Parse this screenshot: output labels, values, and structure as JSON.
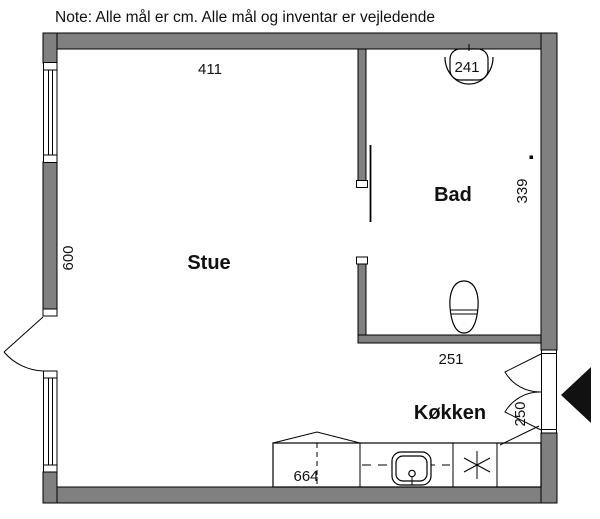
{
  "note": "Note: Alle mål er cm. Alle mål og inventar er vejledende",
  "rooms": {
    "stue": "Stue",
    "bad": "Bad",
    "kokken": "Køkken"
  },
  "dimensions_cm": {
    "stue_top_width": "411",
    "stue_left_height": "600",
    "bad_top_width": "241",
    "bad_right_height": "339",
    "bad_bottom_width": "251",
    "entry_door_width": "250",
    "kitchen_counter": "664"
  },
  "fixtures": {
    "bathroom": [
      "washbasin",
      "toilet"
    ],
    "kitchen": [
      "kitchen-counter",
      "kitchen-sink",
      "cooktop"
    ]
  },
  "doors": [
    "entry-double-door",
    "balcony-door-left",
    "sliding-door-bathroom"
  ],
  "colors": {
    "wall_fill": "#808080",
    "line": "#000000",
    "background": "#ffffff",
    "entrance_arrow": "#111111"
  }
}
